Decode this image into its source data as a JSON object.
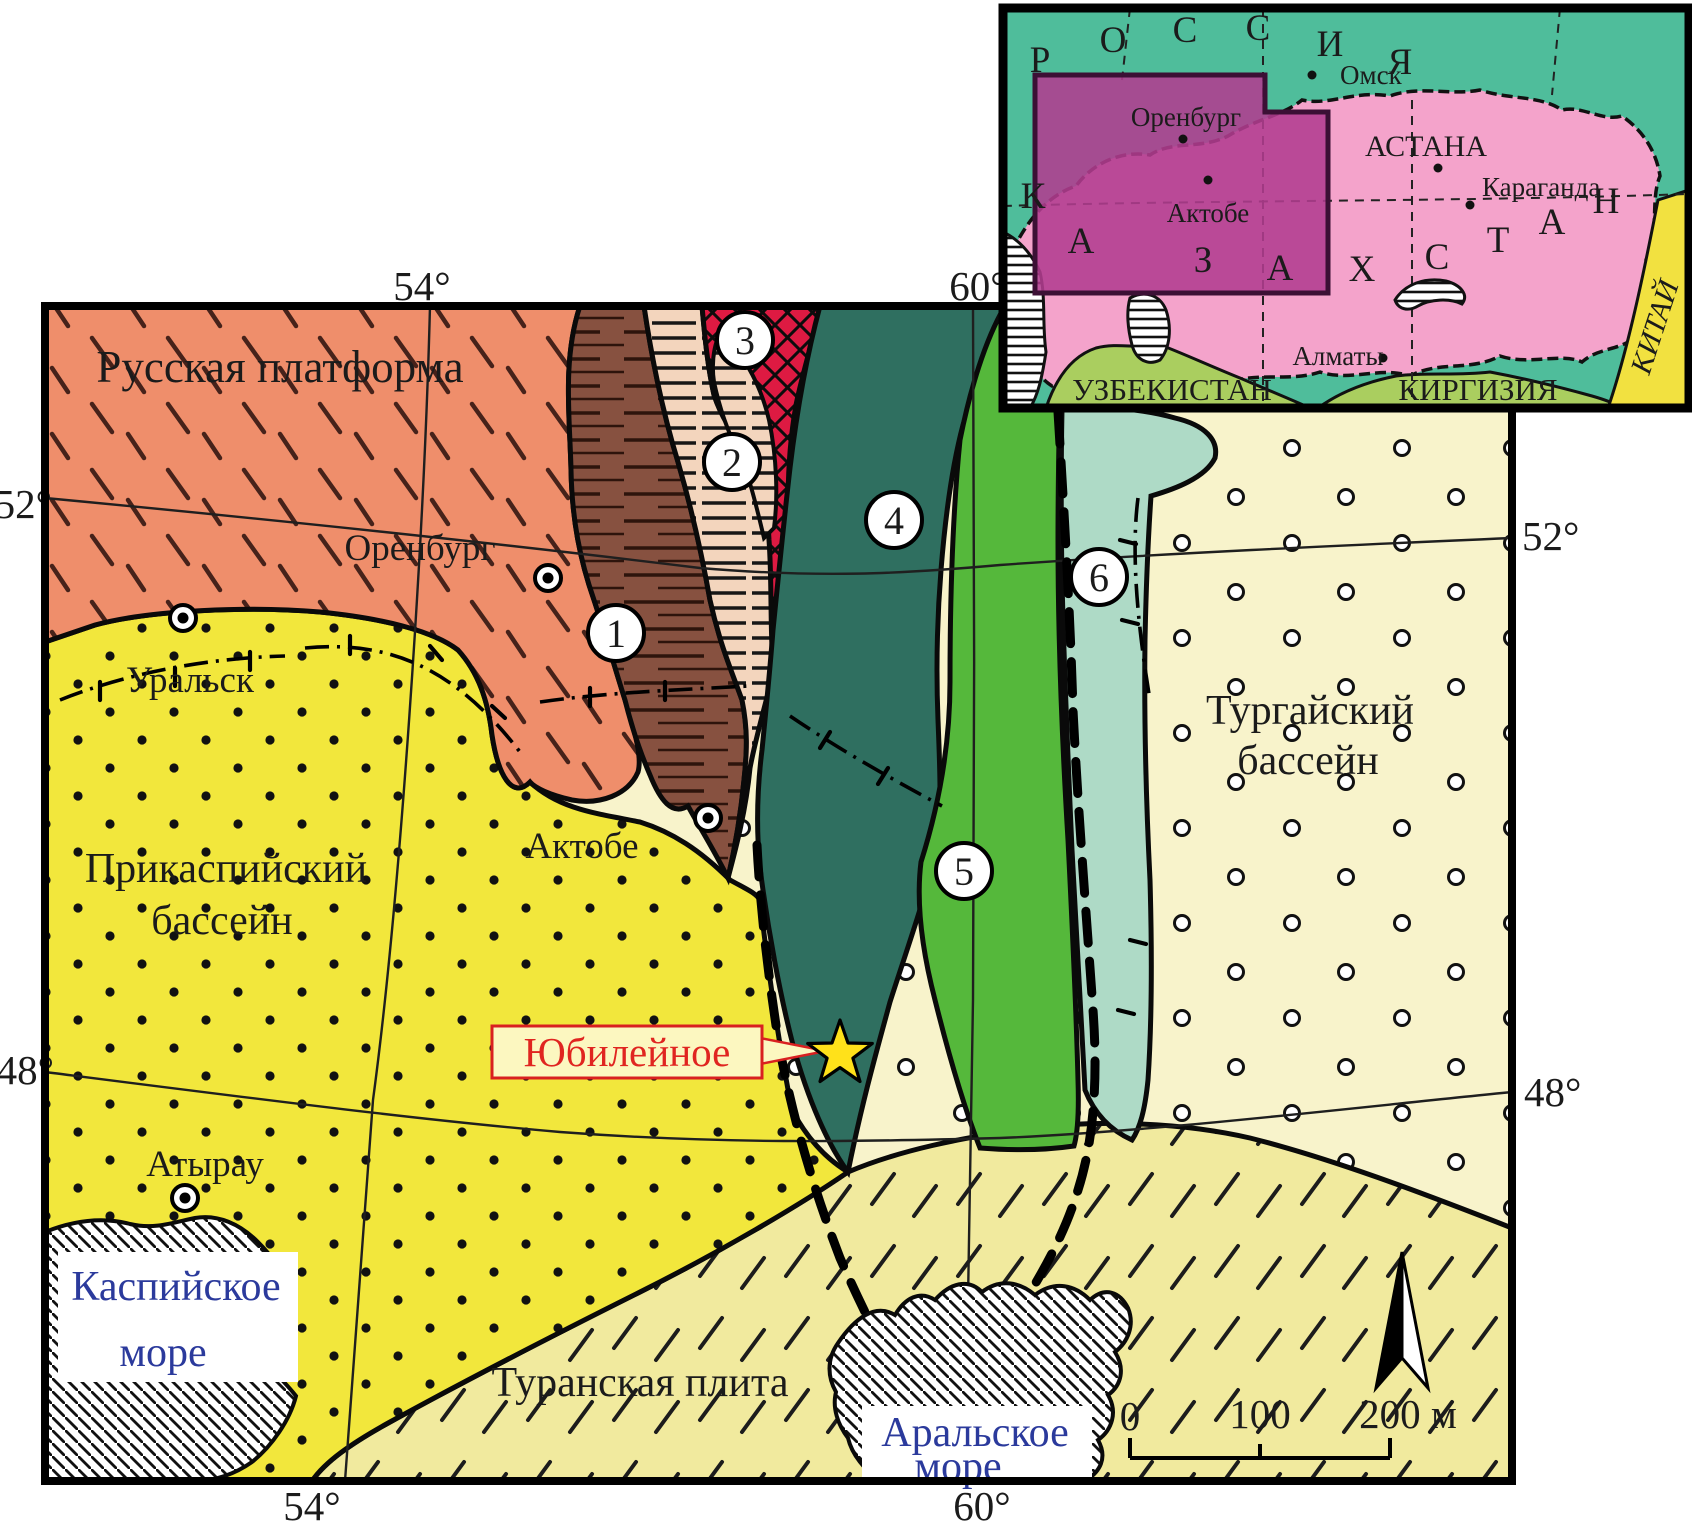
{
  "main_map": {
    "regions": {
      "russian_platform": "Русская платформа",
      "precaspian": {
        "line1": "Прикаспийский",
        "line2": "бассейн"
      },
      "turgai": {
        "line1": "Тургайский",
        "line2": "бассейн"
      },
      "turan": "Туранская плита"
    },
    "cities": {
      "orenburg": "Оренбург",
      "uralsk": "Уральск",
      "aktobe": "Актобе",
      "atyrau": "Атырау"
    },
    "seas": {
      "caspian": {
        "line1": "Каспийское",
        "line2": "море"
      },
      "aral": {
        "line1": "Аральское",
        "line2": "море"
      }
    },
    "deposit_label": "Юбилейное",
    "unit_numbers": [
      "1",
      "2",
      "3",
      "4",
      "5",
      "6"
    ],
    "coordinates": {
      "top_left": "54°",
      "top_right": "60°",
      "bottom_left": "54°",
      "bottom_right": "60°",
      "left_top": "52°",
      "left_bottom": "48°",
      "right_top": "52°",
      "right_bottom": "48°"
    },
    "scale_bar": {
      "tick0": "0",
      "tick1": "100",
      "tick2": "200 м"
    }
  },
  "inset_map": {
    "rossiya_letters": [
      "Р",
      "О",
      "С",
      "С",
      "И",
      "Я"
    ],
    "kazakhstan_letters": [
      "К",
      "А",
      "З",
      "А",
      "Х",
      "С",
      "Т",
      "А",
      "Н"
    ],
    "countries": {
      "uzbekistan": "УЗБЕКИСТАН",
      "kyrgyzstan": "КИРГИЗИЯ",
      "china": "КИТАЙ"
    },
    "cities": {
      "omsk": "Омск",
      "astana": "АСТАНА",
      "karaganda": "Караганда",
      "almaty": "Алматы",
      "orenburg": "Оренбург",
      "aktobe": "Актобе"
    }
  },
  "colors": {
    "russian_platform": "#EF8E6B",
    "precaspian_yellow": "#F2E73C",
    "turgai_pale": "#F8F3CB",
    "turan_pale": "#F1EA9E",
    "unit1_brown": "#875140",
    "unit2_cream": "#F3D5BD",
    "unit3_red": "#DE1A42",
    "unit4_teal": "#2F6F60",
    "unit5_green": "#55B83B",
    "unit6_seafoam": "#AEDAC6",
    "inset_russia": "#4FBD9B",
    "inset_kazakhstan": "#F4A3CB",
    "inset_study_area": "#B23C90",
    "inset_south_green": "#AACE5F",
    "inset_china_yellow": "#F2E140",
    "sea_label_blue": "#2B3A9C",
    "deposit_red": "#E02520"
  }
}
